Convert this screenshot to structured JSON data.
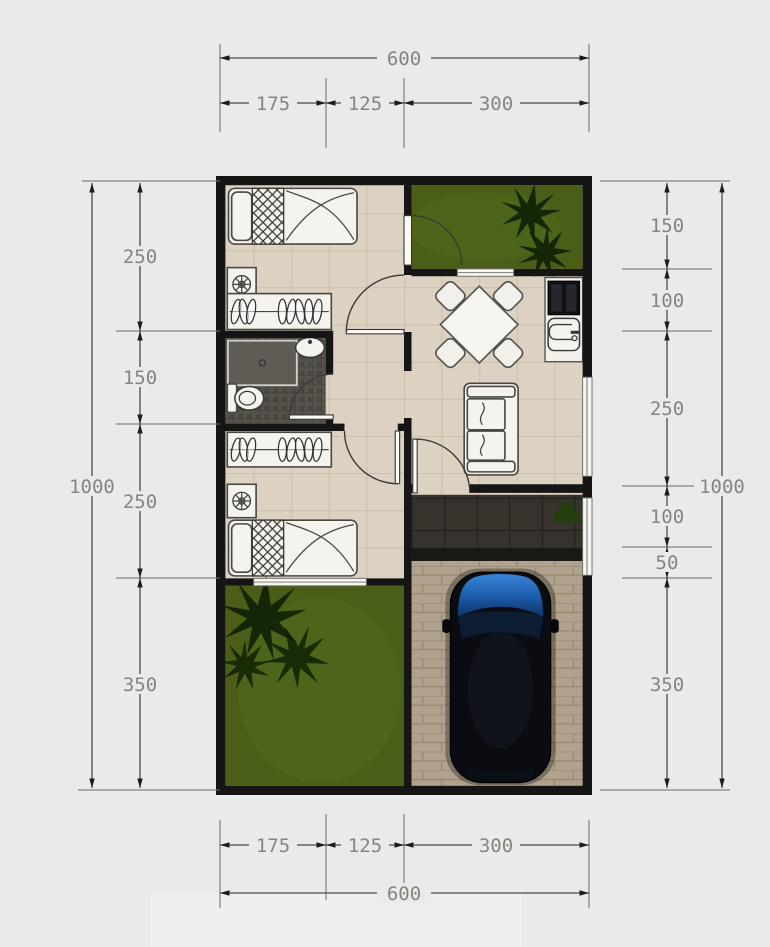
{
  "title": "house-floor-plan-with-dimensions",
  "dimensions": {
    "top": {
      "total": "600",
      "segments": [
        "175",
        "125",
        "300"
      ]
    },
    "bottom": {
      "total": "600",
      "segments": [
        "175",
        "125",
        "300"
      ]
    },
    "left": {
      "total": "1000",
      "segments": [
        "250",
        "150",
        "250",
        "350"
      ]
    },
    "right": {
      "total": "1000",
      "segments": [
        "150",
        "100",
        "250",
        "100",
        "50",
        "350"
      ]
    }
  },
  "colors": {
    "background": "#e9eaea",
    "wall": "#151515",
    "floor_tile": "#ddd2c1",
    "tile_line": "#c6b8a2",
    "bathroom_tile": "#55534b",
    "grass": "#4a5e17",
    "palm_tree": "#102004",
    "paver": "#b0a28c",
    "terrace_tile": "#35332b",
    "car_body": "#0a0c11",
    "car_glass": "#1a5aa8",
    "furniture": "#f4f3ee",
    "dimension_line": "#4a4a48",
    "dimension_text": "#85857f"
  }
}
